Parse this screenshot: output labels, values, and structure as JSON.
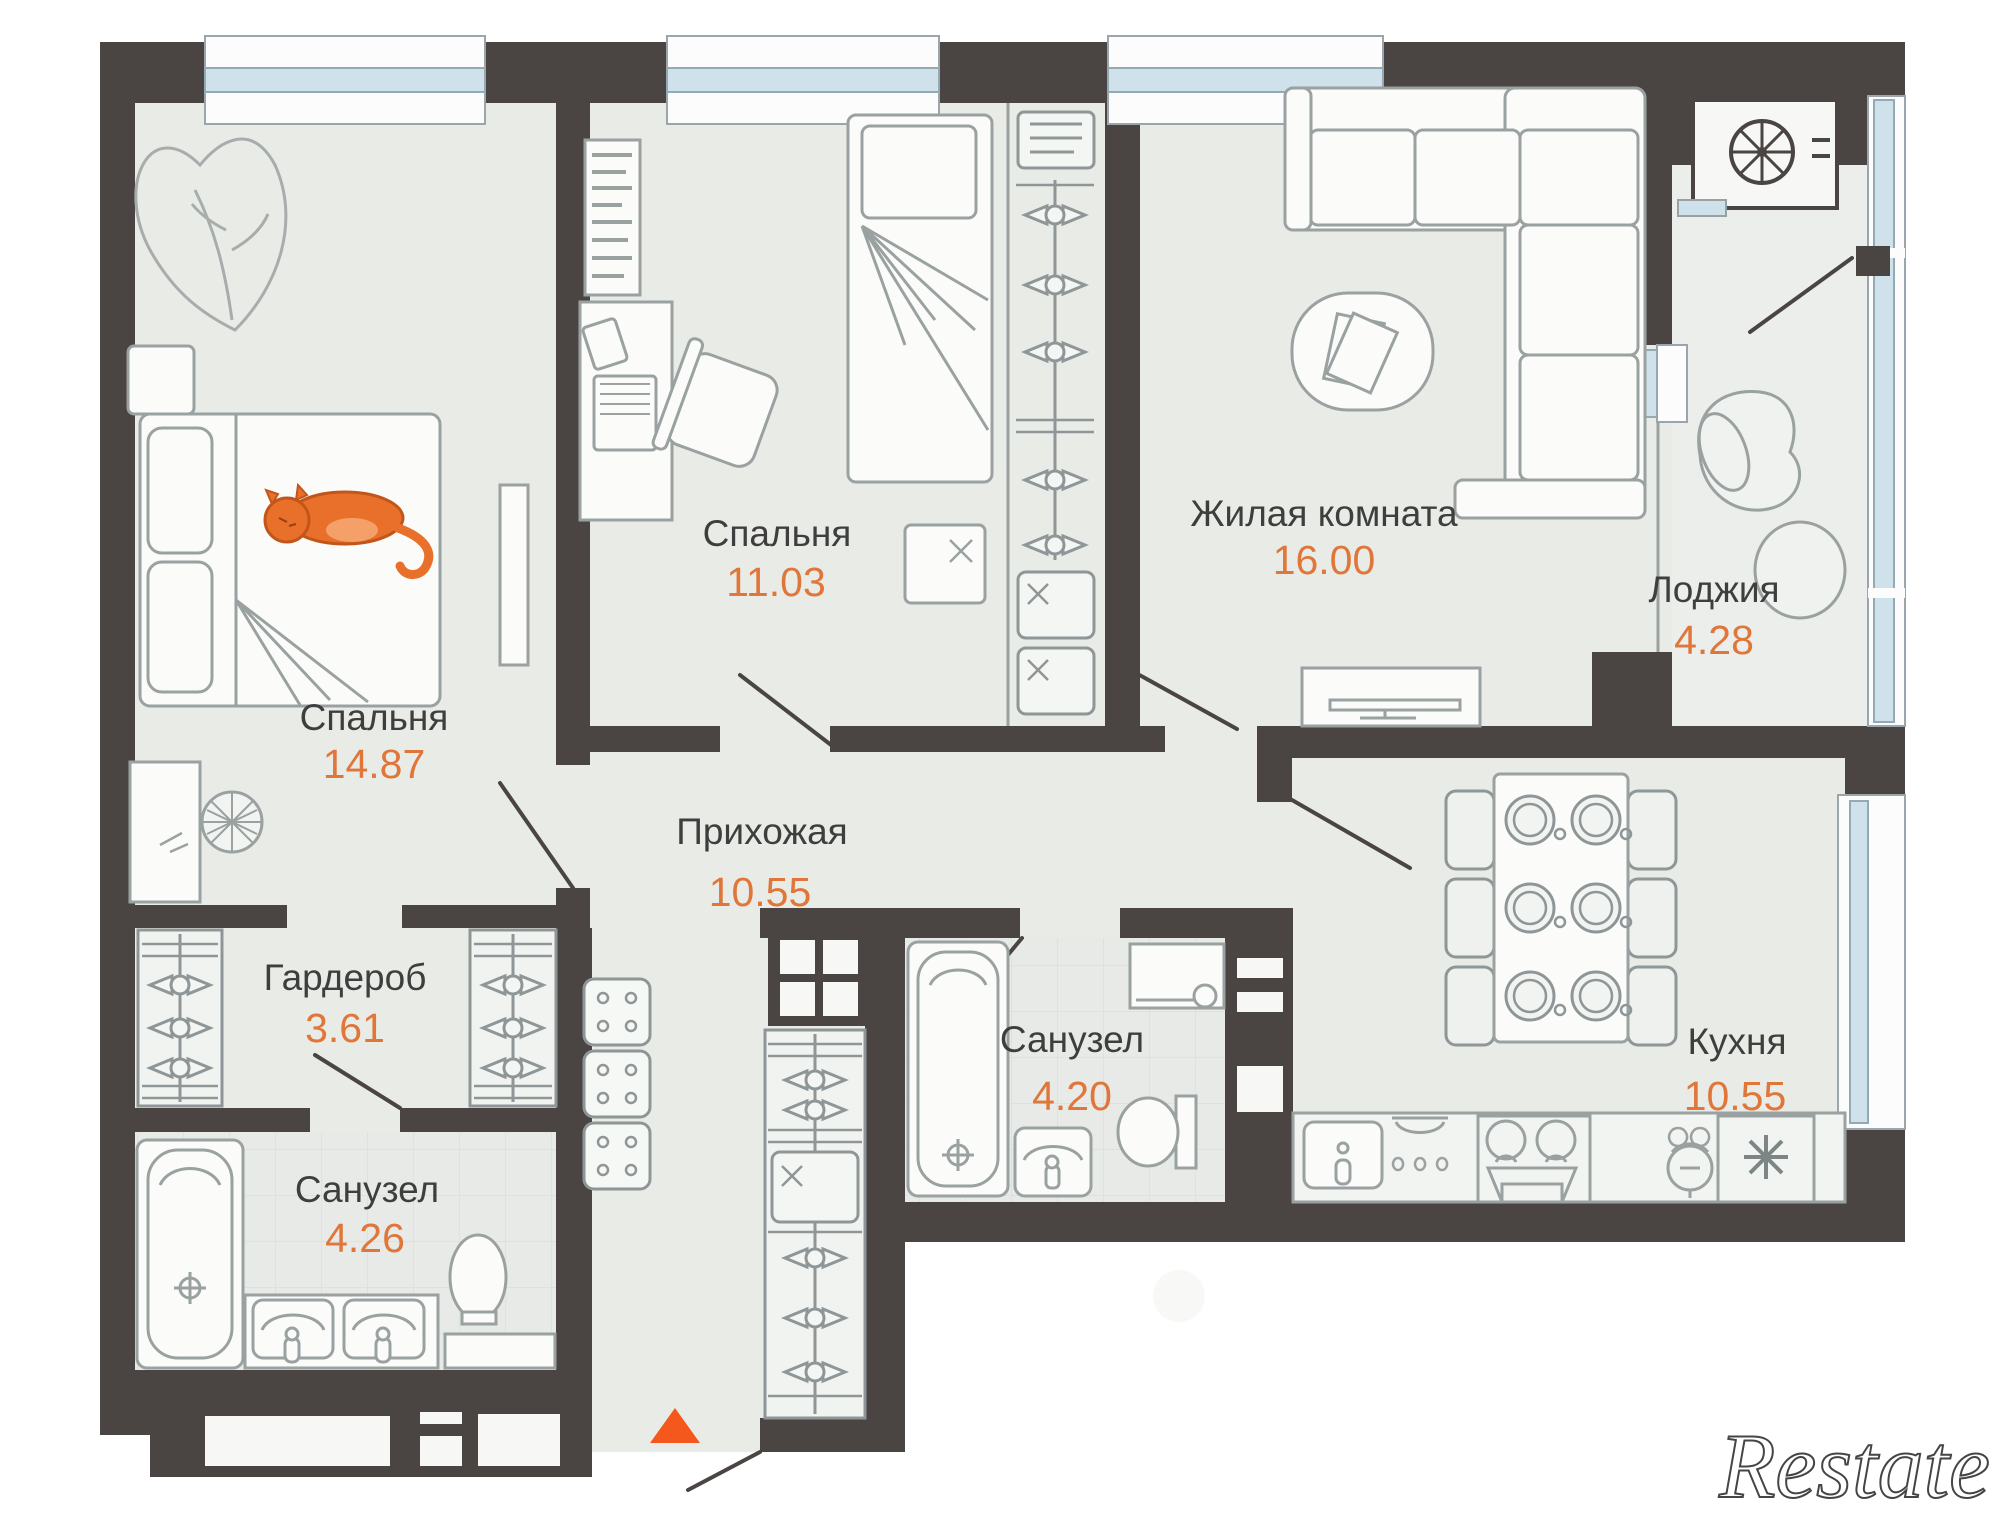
{
  "plan": {
    "rooms": [
      {
        "id": "bedroom-1",
        "name": "Спальня",
        "area": "14.87"
      },
      {
        "id": "bedroom-2",
        "name": "Спальня",
        "area": "11.03"
      },
      {
        "id": "living-room",
        "name": "Жилая комната",
        "area": "16.00"
      },
      {
        "id": "loggia",
        "name": "Лоджия",
        "area": "4.28"
      },
      {
        "id": "hallway",
        "name": "Прихожая",
        "area": "10.55"
      },
      {
        "id": "wardrobe",
        "name": "Гардероб",
        "area": "3.61"
      },
      {
        "id": "bathroom-1",
        "name": "Санузел",
        "area": "4.26"
      },
      {
        "id": "bathroom-2",
        "name": "Санузел",
        "area": "4.20"
      },
      {
        "id": "kitchen",
        "name": "Кухня",
        "area": "10.55"
      }
    ],
    "watermarks": {
      "restate": "Restate",
      "cian": "циан"
    },
    "colors": {
      "wall": "#4a4543",
      "floor": "#e9ece6",
      "bath_floor": "#e7eae7",
      "furniture_line": "#8e9697",
      "window_blue": "#cfe2ec",
      "room_name": "#3e3e3e",
      "area_value": "#e0763a",
      "cat_orange": "#e8702a",
      "entrance_arrow": "#f4581d"
    }
  }
}
